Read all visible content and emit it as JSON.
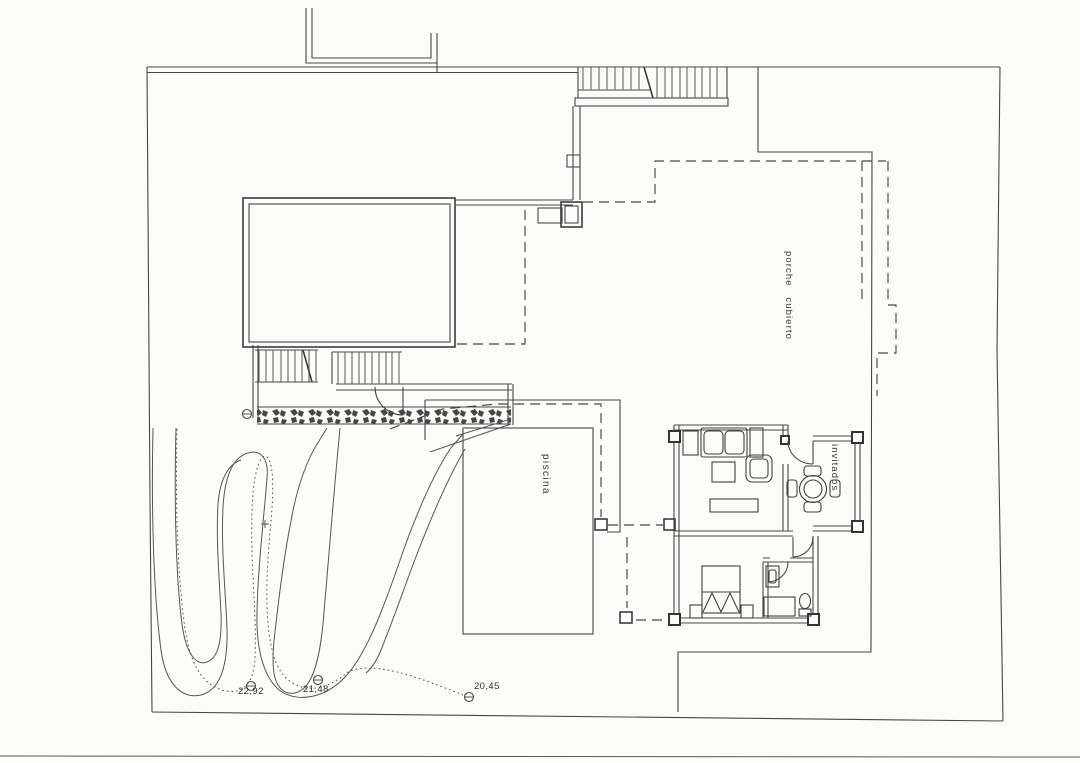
{
  "sheet": {
    "type": "architectural site plan (scanned)",
    "paper_color": "#fcfcfa",
    "line_color": "#474747"
  },
  "plan": {
    "labels": {
      "porch": "porche cubierto",
      "pool": "piscina",
      "guesthouse": "invitados"
    },
    "elevations": [
      {
        "value": "22,92"
      },
      {
        "value": "21,48"
      },
      {
        "value": "20,45"
      }
    ]
  }
}
